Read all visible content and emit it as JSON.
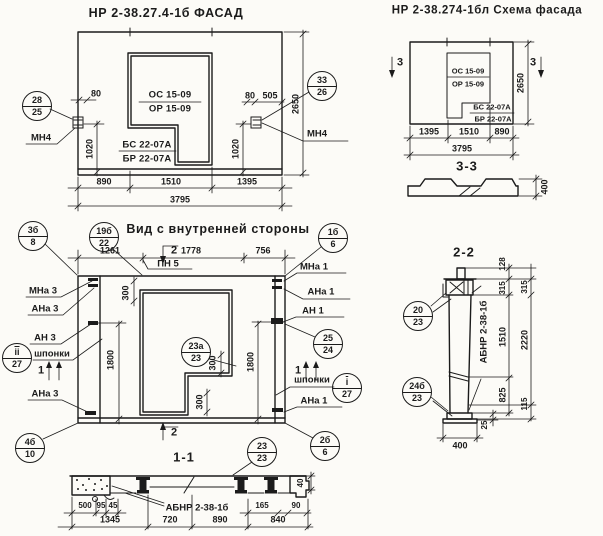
{
  "facade": {
    "title": "НР 2-38.27.4-1б ФАСАД",
    "marks": {
      "os": "ОС 15-09",
      "or": "ОР 15-09",
      "bs": "БС 22-07А",
      "br": "БР 22-07А"
    },
    "anchor_left": "МН4",
    "anchor_right": "МН4",
    "callout_left": {
      "top": "28",
      "bottom": "25"
    },
    "callout_right": {
      "top": "33",
      "bottom": "26"
    },
    "dims": {
      "d80l": "80",
      "d1020l": "1020",
      "d80r": "80",
      "d505": "505",
      "d1020r": "1020",
      "d2650": "2650",
      "d890": "890",
      "d1510": "1510",
      "d1395": "1395",
      "d3795": "3795"
    }
  },
  "schema": {
    "title": "НР 2-38.274-1бл Схема фасада",
    "marks": {
      "os": "ОС 15-09",
      "or": "ОР 15-09",
      "bs": "БС 22-07А",
      "br": "БР 22-07А"
    },
    "section_mark_left": "3",
    "section_mark_right": "3",
    "dims": {
      "d1395": "1395",
      "d1510": "1510",
      "d890": "890",
      "d3795": "3795",
      "d2650": "2650"
    }
  },
  "section33": {
    "title": "3-3",
    "dims": {
      "d400": "400"
    }
  },
  "inner": {
    "title": "Вид с внутренней стороны",
    "labels": {
      "pn5": "ПН 5",
      "mna3": "МНа 3",
      "ana3_top": "АНа 3",
      "an3": "АН 3",
      "shponki_left": "шпонки",
      "ana3_bottom": "АНа 3",
      "mna1": "МНа 1",
      "ana1_top": "АНа 1",
      "an1": "АН 1",
      "shponki_right": "шпонки",
      "ana1_bottom": "АНа 1"
    },
    "flags": {
      "cut2_top": "2",
      "cut2_bottom": "2",
      "cut1_left": "1",
      "cut1_right": "1"
    },
    "callouts": {
      "c3b8": {
        "top": "3б",
        "bottom": "8"
      },
      "c19b22": {
        "top": "19б",
        "bottom": "22"
      },
      "c1b6": {
        "top": "1б",
        "bottom": "6"
      },
      "c23a23": {
        "top": "23а",
        "bottom": "23"
      },
      "c2524": {
        "top": "25",
        "bottom": "24"
      },
      "cii27": {
        "top": "ii",
        "bottom": "27"
      },
      "ci27": {
        "top": "i",
        "bottom": "27"
      },
      "c4b10": {
        "top": "4б",
        "bottom": "10"
      },
      "c2b6": {
        "top": "2б",
        "bottom": "6"
      }
    },
    "dims": {
      "d1261": "1261",
      "d1778": "1778",
      "d756": "756",
      "d300_top": "300",
      "d300_mid": "300",
      "d300_bottom": "300",
      "d1800_left": "1800",
      "d1800_right": "1800"
    }
  },
  "section11": {
    "title": "1-1",
    "part_label": "АБНР 2-38-1б",
    "callout": {
      "top": "23",
      "bottom": "23"
    },
    "dims": {
      "d500": "500",
      "d95": "95",
      "d45": "45",
      "d1345": "1345",
      "d720": "720",
      "d890": "890",
      "d165": "165",
      "d90": "90",
      "d840": "840",
      "d40": "40"
    }
  },
  "section22": {
    "title": "2-2",
    "part_label": "АБНР 2-38-1б",
    "callouts": {
      "c2023": {
        "top": "20",
        "bottom": "23"
      },
      "c24b23": {
        "top": "24б",
        "bottom": "23"
      }
    },
    "dims": {
      "d128": "128",
      "d315_a": "315",
      "d315_b": "315",
      "d1510": "1510",
      "d2220": "2220",
      "d825": "825",
      "d115": "115",
      "d25": "25",
      "d400": "400"
    }
  }
}
